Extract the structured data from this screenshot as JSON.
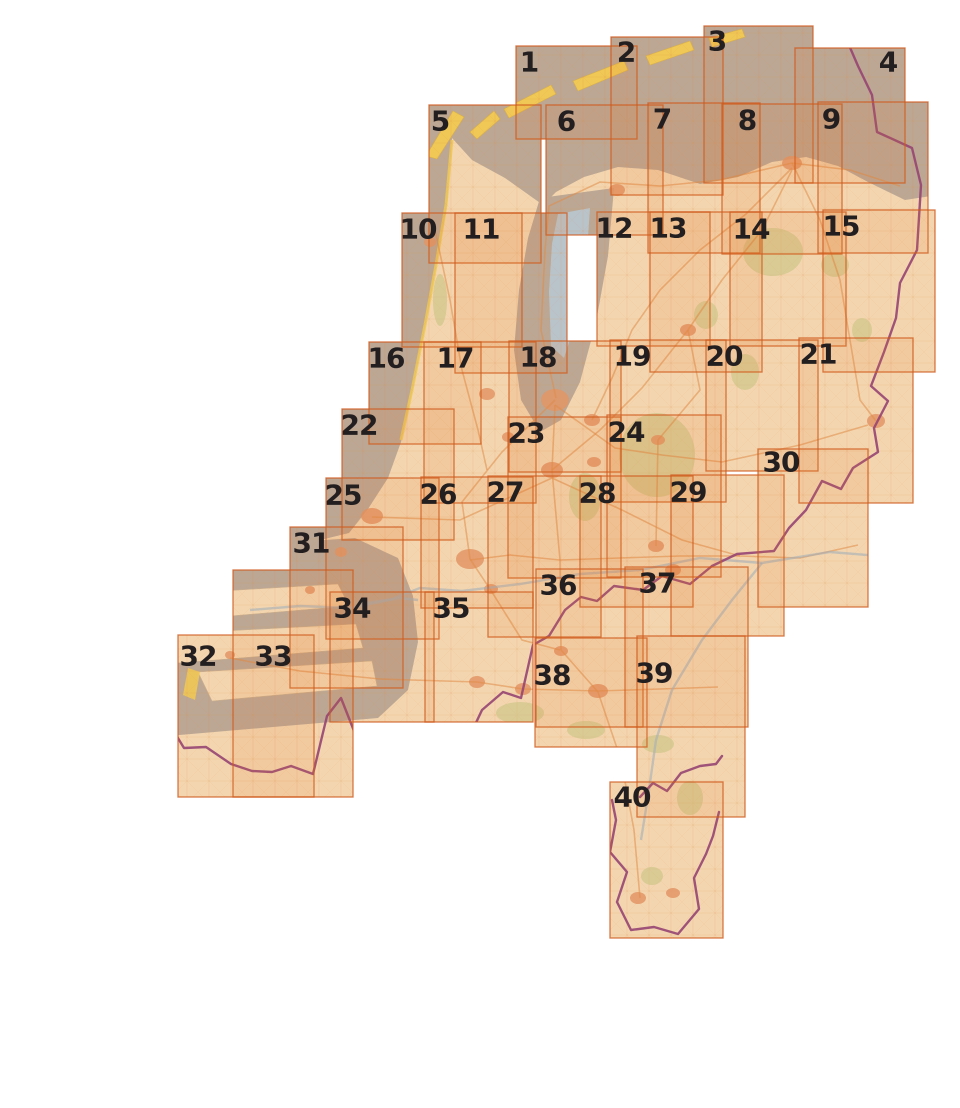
{
  "figure": {
    "type": "map-sheet-index",
    "region": "Netherlands",
    "description": "Index of 40 numbered map sheets covering the Netherlands"
  },
  "canvas": {
    "width": 960,
    "height": 1108
  },
  "colors": {
    "page_bg": "#ffffff",
    "sea": "#b7aea3",
    "land": "#f5e3c2",
    "water_blue": "#b4cfe0",
    "dune_yellow": "#f2d35c",
    "forest_green": "#c9cf92",
    "city_salmon": "#e39a6f",
    "border_purple": "#8d3f7c",
    "road_orange": "#e0904f",
    "sheet_fill": "#e86e20",
    "sheet_fill_opacity": 0.115,
    "sheet_stroke": "#cf5a1d",
    "sheet_stroke_opacity": 0.8,
    "label_color": "#231f20"
  },
  "sheets": [
    {
      "n": "1",
      "x": 516,
      "y": 46,
      "w": 121,
      "h": 93,
      "lx": 529,
      "ly": 62
    },
    {
      "n": "2",
      "x": 611,
      "y": 37,
      "w": 112,
      "h": 158,
      "lx": 626,
      "ly": 52
    },
    {
      "n": "3",
      "x": 704,
      "y": 26,
      "w": 109,
      "h": 157,
      "lx": 717,
      "ly": 41
    },
    {
      "n": "4",
      "x": 795,
      "y": 48,
      "w": 110,
      "h": 135,
      "lx": 888,
      "ly": 62
    },
    {
      "n": "5",
      "x": 429,
      "y": 105,
      "w": 112,
      "h": 158,
      "lx": 440,
      "ly": 121
    },
    {
      "n": "6",
      "x": 546,
      "y": 105,
      "w": 117,
      "h": 130,
      "lx": 566,
      "ly": 121
    },
    {
      "n": "7",
      "x": 648,
      "y": 103,
      "w": 112,
      "h": 150,
      "lx": 662,
      "ly": 119
    },
    {
      "n": "8",
      "x": 722,
      "y": 104,
      "w": 120,
      "h": 150,
      "lx": 747,
      "ly": 120
    },
    {
      "n": "9",
      "x": 818,
      "y": 102,
      "w": 110,
      "h": 151,
      "lx": 831,
      "ly": 119
    },
    {
      "n": "10",
      "x": 402,
      "y": 213,
      "w": 120,
      "h": 134,
      "lx": 418,
      "ly": 229
    },
    {
      "n": "11",
      "x": 455,
      "y": 213,
      "w": 112,
      "h": 160,
      "lx": 481,
      "ly": 229
    },
    {
      "n": "12",
      "x": 597,
      "y": 212,
      "w": 113,
      "h": 134,
      "lx": 614,
      "ly": 228
    },
    {
      "n": "13",
      "x": 650,
      "y": 212,
      "w": 112,
      "h": 160,
      "lx": 668,
      "ly": 228
    },
    {
      "n": "14",
      "x": 730,
      "y": 212,
      "w": 116,
      "h": 134,
      "lx": 751,
      "ly": 229
    },
    {
      "n": "15",
      "x": 823,
      "y": 210,
      "w": 112,
      "h": 162,
      "lx": 841,
      "ly": 226
    },
    {
      "n": "16",
      "x": 369,
      "y": 342,
      "w": 112,
      "h": 102,
      "lx": 386,
      "ly": 358
    },
    {
      "n": "17",
      "x": 424,
      "y": 342,
      "w": 112,
      "h": 161,
      "lx": 455,
      "ly": 358
    },
    {
      "n": "18",
      "x": 509,
      "y": 341,
      "w": 112,
      "h": 131,
      "lx": 538,
      "ly": 357
    },
    {
      "n": "19",
      "x": 610,
      "y": 340,
      "w": 116,
      "h": 162,
      "lx": 632,
      "ly": 356
    },
    {
      "n": "20",
      "x": 706,
      "y": 340,
      "w": 112,
      "h": 131,
      "lx": 724,
      "ly": 356
    },
    {
      "n": "21",
      "x": 799,
      "y": 338,
      "w": 114,
      "h": 165,
      "lx": 818,
      "ly": 354
    },
    {
      "n": "22",
      "x": 342,
      "y": 409,
      "w": 112,
      "h": 131,
      "lx": 359,
      "ly": 425
    },
    {
      "n": "23",
      "x": 508,
      "y": 417,
      "w": 113,
      "h": 161,
      "lx": 526,
      "ly": 433
    },
    {
      "n": "24",
      "x": 607,
      "y": 415,
      "w": 114,
      "h": 162,
      "lx": 626,
      "ly": 432
    },
    {
      "n": "25",
      "x": 326,
      "y": 478,
      "w": 113,
      "h": 161,
      "lx": 343,
      "ly": 495
    },
    {
      "n": "26",
      "x": 421,
      "y": 477,
      "w": 112,
      "h": 131,
      "lx": 438,
      "ly": 494
    },
    {
      "n": "27",
      "x": 488,
      "y": 476,
      "w": 113,
      "h": 161,
      "lx": 505,
      "ly": 492
    },
    {
      "n": "28",
      "x": 580,
      "y": 476,
      "w": 113,
      "h": 131,
      "lx": 597,
      "ly": 493
    },
    {
      "n": "29",
      "x": 671,
      "y": 475,
      "w": 113,
      "h": 161,
      "lx": 688,
      "ly": 492
    },
    {
      "n": "30",
      "x": 758,
      "y": 449,
      "w": 110,
      "h": 158,
      "lx": 781,
      "ly": 462
    },
    {
      "n": "31",
      "x": 290,
      "y": 527,
      "w": 113,
      "h": 161,
      "lx": 311,
      "ly": 543
    },
    {
      "n": "32",
      "x": 178,
      "y": 635,
      "w": 136,
      "h": 162,
      "lx": 198,
      "ly": 656
    },
    {
      "n": "33",
      "x": 233,
      "y": 570,
      "w": 120,
      "h": 227,
      "lx": 273,
      "ly": 656
    },
    {
      "n": "34",
      "x": 330,
      "y": 592,
      "w": 104,
      "h": 130,
      "lx": 352,
      "ly": 608
    },
    {
      "n": "35",
      "x": 425,
      "y": 592,
      "w": 108,
      "h": 130,
      "lx": 451,
      "ly": 608
    },
    {
      "n": "36",
      "x": 536,
      "y": 569,
      "w": 107,
      "h": 158,
      "lx": 558,
      "ly": 585
    },
    {
      "n": "37",
      "x": 625,
      "y": 567,
      "w": 123,
      "h": 160,
      "lx": 657,
      "ly": 583
    },
    {
      "n": "38",
      "x": 535,
      "y": 638,
      "w": 112,
      "h": 109,
      "lx": 552,
      "ly": 675
    },
    {
      "n": "39",
      "x": 637,
      "y": 636,
      "w": 108,
      "h": 181,
      "lx": 654,
      "ly": 673
    },
    {
      "n": "40",
      "x": 610,
      "y": 782,
      "w": 113,
      "h": 156,
      "lx": 632,
      "ly": 797
    }
  ],
  "base_map": {
    "sea_polys": [
      "140,-20 970,-20 970,190 905,200 868,182 838,166 806,157 772,162 738,177 700,184 658,170 618,167 584,177 556,192 543,205 505,178 472,160 452,138 425,112 395,92 340,76 140,58",
      "140,58 340,76 395,92 425,112 452,138 447,205 437,262 426,322 413,388 401,442 388,478 368,509 349,533 300,545 140,560",
      "540,198 614,188 608,256 596,322 580,382 561,420 540,432 521,400 514,350 519,290 528,238",
      "145,552 355,538 398,558 413,596 418,642 408,690 378,718 145,738"
    ],
    "ijsselmeer_blue": "558,214 590,208 586,266 575,324 564,358 551,346 549,292 552,244",
    "zeeland_strips": [
      "172,594 338,584 349,606 183,620",
      "167,634 356,624 363,648 178,663",
      "198,672 372,661 377,686 212,701"
    ],
    "zeeland_dunes": [
      "164,590 177,594 171,622 158,616",
      "158,632 172,636 166,664 153,658",
      "188,668 200,672 195,700 183,695"
    ],
    "islands": [
      "426,156 437,159 464,117 453,111",
      "470,132 494,111 500,119 477,139",
      "504,109 551,85 556,94 509,118",
      "573,81 624,61 628,70 578,91",
      "646,56 690,41 694,50 650,65",
      "709,38 742,29 745,37 712,47"
    ],
    "coast_dune_line": "452,140 446,205 436,265 425,325 412,390 401,440",
    "forests": [
      [
        657,
        455,
        38,
        42
      ],
      [
        585,
        497,
        16,
        24
      ],
      [
        773,
        252,
        30,
        24
      ],
      [
        745,
        372,
        14,
        18
      ],
      [
        706,
        315,
        12,
        14
      ],
      [
        520,
        713,
        24,
        11
      ],
      [
        586,
        730,
        19,
        9
      ],
      [
        658,
        744,
        16,
        9
      ],
      [
        690,
        798,
        13,
        17
      ],
      [
        652,
        876,
        11,
        9
      ],
      [
        440,
        300,
        7,
        26
      ],
      [
        835,
        265,
        14,
        12
      ],
      [
        862,
        330,
        10,
        12
      ]
    ],
    "cities": [
      [
        555,
        400,
        14,
        11
      ],
      [
        487,
        394,
        8,
        6
      ],
      [
        372,
        516,
        11,
        8
      ],
      [
        470,
        559,
        14,
        10
      ],
      [
        552,
        470,
        11,
        8
      ],
      [
        592,
        420,
        8,
        6
      ],
      [
        594,
        462,
        7,
        5
      ],
      [
        792,
        163,
        10,
        7
      ],
      [
        617,
        190,
        8,
        6
      ],
      [
        688,
        330,
        8,
        6
      ],
      [
        876,
        421,
        9,
        7
      ],
      [
        656,
        546,
        8,
        6
      ],
      [
        673,
        570,
        8,
        6
      ],
      [
        561,
        651,
        7,
        5
      ],
      [
        598,
        691,
        10,
        7
      ],
      [
        523,
        689,
        8,
        6
      ],
      [
        477,
        682,
        8,
        6
      ],
      [
        491,
        589,
        7,
        5
      ],
      [
        658,
        440,
        7,
        5
      ],
      [
        638,
        898,
        8,
        6
      ],
      [
        673,
        893,
        7,
        5
      ],
      [
        230,
        655,
        5,
        4
      ],
      [
        310,
        590,
        5,
        4
      ],
      [
        341,
        552,
        6,
        5
      ],
      [
        430,
        242,
        6,
        5
      ],
      [
        508,
        437,
        6,
        5
      ]
    ],
    "roads": [
      "555,405 615,448 662,455 722,462 800,445 868,425",
      "555,405 552,470 560,560 561,650 598,692 621,760 634,830 640,898",
      "372,517 460,520 552,478 622,510 682,540 740,556 800,558 858,545",
      "555,400 502,452 462,502 470,559 490,589 522,640 560,650",
      "556,398 541,330 545,250 549,206 600,182 660,186 720,180 792,163 850,170 900,186",
      "592,420 612,378 632,330 660,290 700,250 746,214 792,168",
      "552,470 600,430 642,388 672,350 688,330 722,280 762,230 792,170",
      "230,658 300,671 380,679 477,682 523,689 598,691 660,689 718,687",
      "470,560 510,555 560,560 620,558 680,556 740,556",
      "792,163 820,220 840,280 850,340 860,400 876,421",
      "435,230 450,300 462,370 478,430 487,470",
      "688,330 700,390 658,440 656,546"
    ],
    "rivers": [
      "905,558 830,552 762,563 700,558 640,570 580,574 520,584 462,591 420,588 392,599 360,604",
      "762,563 732,600 702,640 672,690 656,740 649,790 641,840",
      "250,610 300,606 350,608 400,598 418,600"
    ],
    "border_paths": [
      "845,36 858,66 872,95 877,132 912,148 921,185 917,250 900,283 896,318 884,352 871,386 888,401 874,428 878,452 853,468 841,489 822,481 806,510 789,528 774,551 737,554 712,566 690,584 662,576 643,590 614,586 597,601 581,597 565,610 549,636 533,645 521,698 503,692 482,710 466,744 441,736 427,752 402,740 374,727 356,736 341,698 327,716 313,774 291,766 272,772 252,771 231,764 206,747 184,748 162,712",
      "719,812 713,836 706,854 694,878 699,909 678,934 654,927 631,930 617,902 627,872 610,852 616,820 612,800",
      "640,797 653,783 667,791 681,773 700,766 716,764 722,756"
    ]
  }
}
